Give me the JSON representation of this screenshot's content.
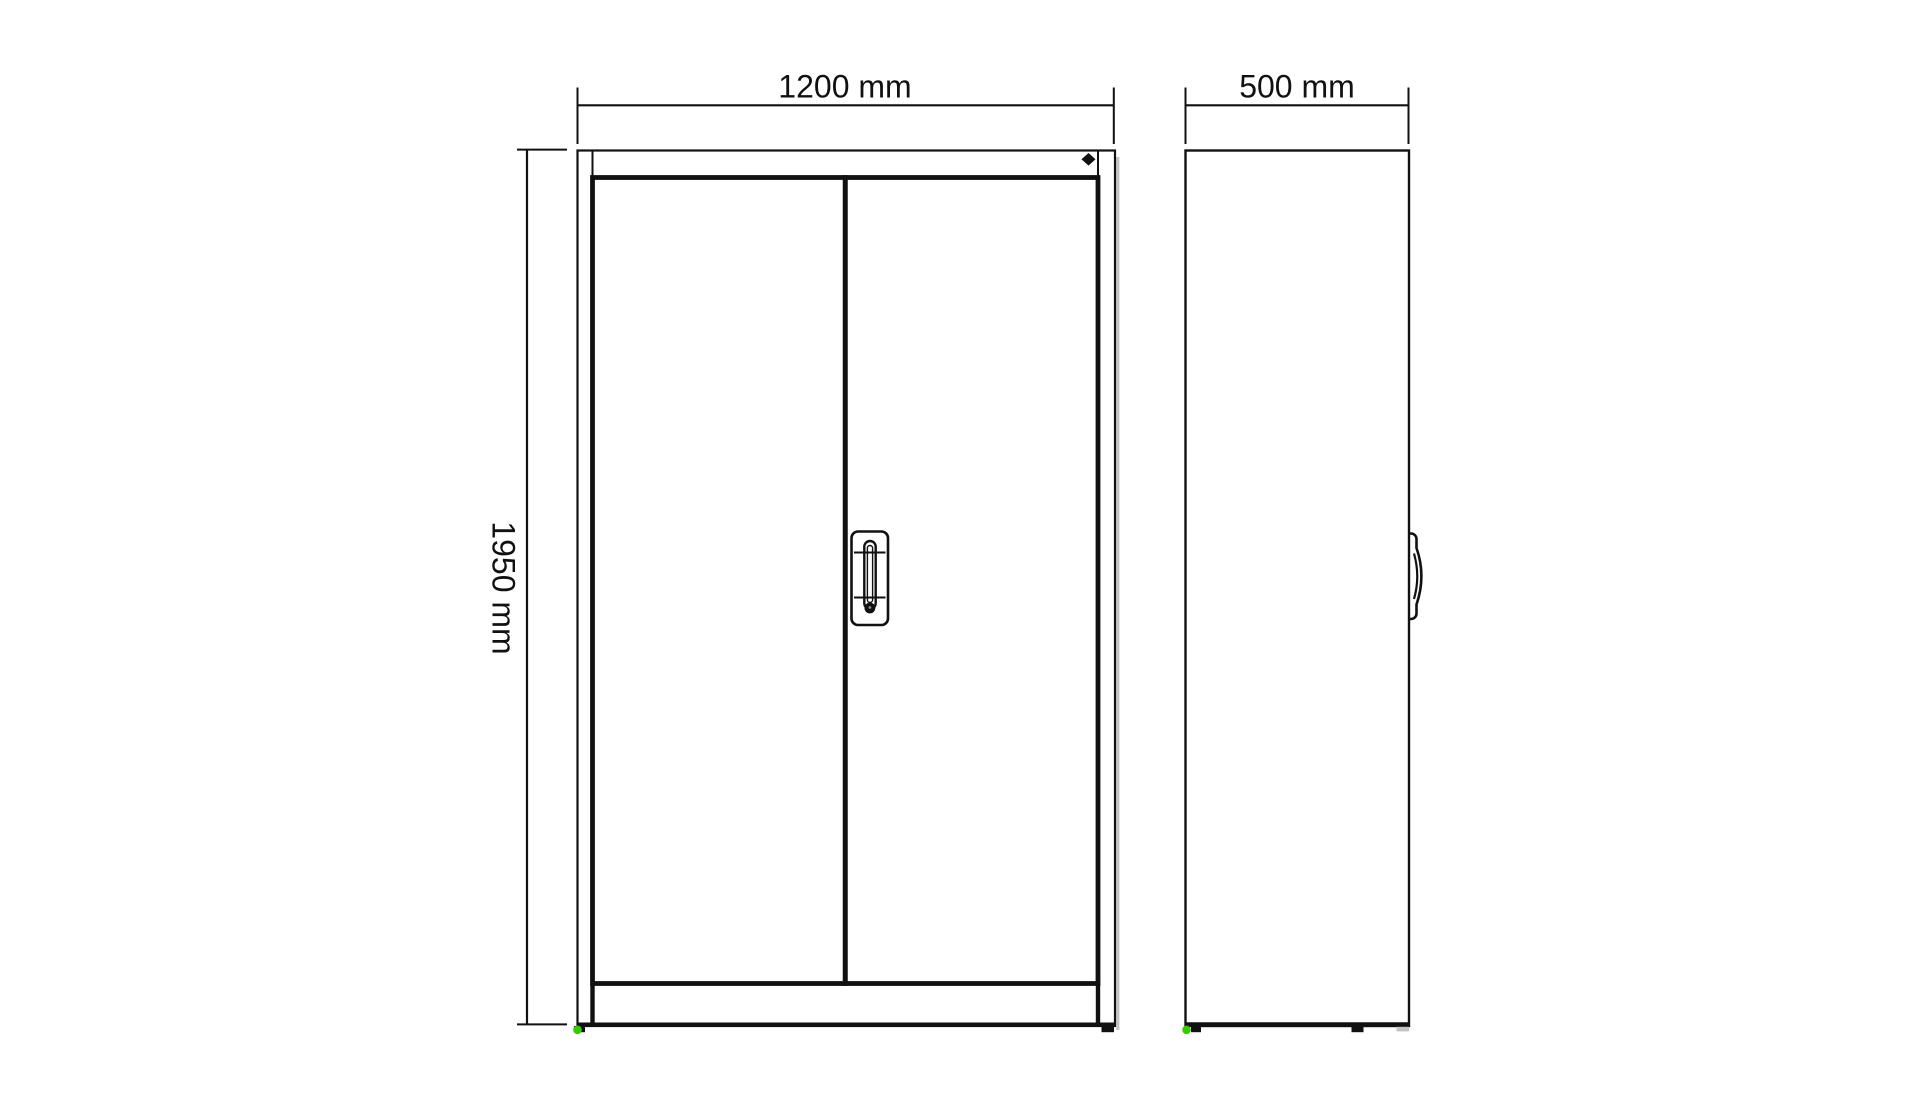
{
  "drawing": {
    "dimension_labels": {
      "width": "1200 mm",
      "depth": "500 mm",
      "height": "1950 mm"
    },
    "colors": {
      "background": "#ffffff",
      "panel_fill": "#e9e9e9",
      "handle_fill": "#ebebeb",
      "line": "#111111",
      "marker_green": "#33cc00",
      "shadow": "#c4c4c4"
    },
    "icons": {
      "lock_indicator": "diamond-icon",
      "corner_marker": "green-dot-icon",
      "keyhole": "keyhole-dot-icon"
    }
  }
}
